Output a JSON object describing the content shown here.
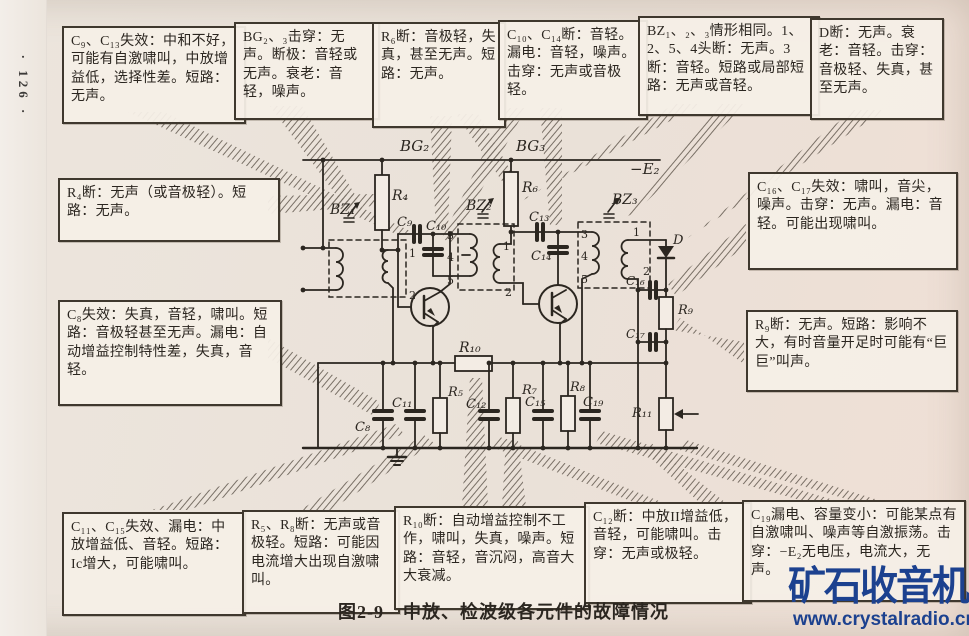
{
  "page_number": "· 126 ·",
  "caption": "图2-9　中放、检波级各元件的故障情况",
  "watermark": {
    "title": "矿石收音机",
    "site": "www.crystalradio.cn",
    "color": "#1c418f"
  },
  "fault_boxes": {
    "c9_c13": {
      "text": "C₉、C₁₃失效：中和不好，可能有自激啸叫，中放增益低，选择性差。短路：无声。"
    },
    "bg2_3": {
      "text": "BG₂、₃击穿：无声。断极：音轻或无声。衰老：音轻，噪声。"
    },
    "r6": {
      "text": "R₆断：音极轻，失真，甚至无声。短路：无声。"
    },
    "c10_c14": {
      "text": "C₁₀、C₁₄断：音轻。漏电：音轻，噪声。击穿：无声或音极轻。"
    },
    "bz1_2_3": {
      "text": "BZ₁、₂、₃情形相同。1、2、5、4头断：无声。3断：音轻。短路或局部短路：无声或音轻。"
    },
    "d": {
      "text": "D断：无声。衰老：音轻。击穿：音极轻、失真，甚至无声。"
    },
    "r4": {
      "text": "R₄断：无声（或音极轻）。短路：无声。"
    },
    "c8": {
      "text": "C₈失效：失真，音轻，啸叫。短路：音极轻甚至无声。漏电：自动增益控制特性差，失真，音轻。"
    },
    "c16_c17": {
      "text": "C₁₆、C₁₇失效：啸叫，音尖，噪声。击穿：无声。漏电：音轻。可能出现啸叫。"
    },
    "r9": {
      "text": "R₉断：无声。短路：影响不大，有时音量开足时可能有“巨巨”叫声。"
    },
    "c11_c15": {
      "text": "C₁₁、C₁₅失效、漏电：中放增益低、音轻。短路：Ic增大，可能啸叫。"
    },
    "r5_r8": {
      "text": "R₅、R₈断：无声或音极轻。短路：可能因电流增大出现自激啸叫。"
    },
    "r10": {
      "text": "R₁₀断：自动增益控制不工作，啸叫，失真，噪声。短路：音轻，音沉闷，高音大大衰减。"
    },
    "c12": {
      "text": "C₁₂断：中放II增益低，音轻，可能啸叫。击穿：无声或极轻。"
    },
    "c19": {
      "text": "C₁₉漏电、容量变小：可能某点有自激啸叫、噪声等自激振荡。击穿：−E₂无电压，电流大，无声。"
    }
  },
  "circuit": {
    "labels": [
      {
        "t": "BG₂",
        "x": 400,
        "y": 151,
        "s": 15,
        "i": 1
      },
      {
        "t": "BG₃",
        "x": 516,
        "y": 151,
        "s": 15,
        "i": 1
      },
      {
        "t": "−E₂",
        "x": 630,
        "y": 174,
        "s": 15,
        "i": 1
      },
      {
        "t": "BZ₁",
        "x": 330,
        "y": 214,
        "s": 14,
        "i": 1
      },
      {
        "t": "BZ₂",
        "x": 466,
        "y": 210,
        "s": 14,
        "i": 1
      },
      {
        "t": "BZ₃",
        "x": 612,
        "y": 204,
        "s": 14,
        "i": 1
      },
      {
        "t": "R₄",
        "x": 392,
        "y": 200,
        "s": 14,
        "i": 1
      },
      {
        "t": "R₆",
        "x": 522,
        "y": 192,
        "s": 14,
        "i": 1
      },
      {
        "t": "C₉",
        "x": 397,
        "y": 226,
        "s": 13,
        "i": 1
      },
      {
        "t": "C₁₀",
        "x": 426,
        "y": 230,
        "s": 13,
        "i": 1
      },
      {
        "t": "C₁₃",
        "x": 529,
        "y": 221,
        "s": 13,
        "i": 1
      },
      {
        "t": "C₁₄",
        "x": 531,
        "y": 260,
        "s": 13,
        "i": 1
      },
      {
        "t": "R₁₀",
        "x": 459,
        "y": 352,
        "s": 14,
        "i": 1
      },
      {
        "t": "C₈",
        "x": 355,
        "y": 431,
        "s": 13,
        "i": 1
      },
      {
        "t": "C₁₁",
        "x": 392,
        "y": 407,
        "s": 13,
        "i": 1
      },
      {
        "t": "R₅",
        "x": 448,
        "y": 396,
        "s": 13,
        "i": 1
      },
      {
        "t": "C₁₂",
        "x": 466,
        "y": 408,
        "s": 13,
        "i": 1
      },
      {
        "t": "R₇",
        "x": 522,
        "y": 394,
        "s": 13,
        "i": 1
      },
      {
        "t": "C₁₅",
        "x": 525,
        "y": 406,
        "s": 13,
        "i": 1
      },
      {
        "t": "R₈",
        "x": 570,
        "y": 391,
        "s": 13,
        "i": 1
      },
      {
        "t": "C₁₉",
        "x": 583,
        "y": 406,
        "s": 13,
        "i": 1
      },
      {
        "t": "R₉",
        "x": 678,
        "y": 314,
        "s": 13,
        "i": 1
      },
      {
        "t": "C₁₆",
        "x": 626,
        "y": 285,
        "s": 12,
        "i": 1
      },
      {
        "t": "C₁₇",
        "x": 626,
        "y": 338,
        "s": 12,
        "i": 1
      },
      {
        "t": "R₁₁",
        "x": 632,
        "y": 417,
        "s": 13,
        "i": 1
      },
      {
        "t": "D",
        "x": 673,
        "y": 244,
        "s": 13,
        "i": 1
      },
      {
        "t": "1",
        "x": 409,
        "y": 257,
        "s": 11
      },
      {
        "t": "2",
        "x": 409,
        "y": 299,
        "s": 11
      },
      {
        "t": "3",
        "x": 447,
        "y": 239,
        "s": 11
      },
      {
        "t": "4",
        "x": 447,
        "y": 261,
        "s": 11
      },
      {
        "t": "5",
        "x": 447,
        "y": 284,
        "s": 11
      },
      {
        "t": "1",
        "x": 503,
        "y": 250,
        "s": 11
      },
      {
        "t": "2",
        "x": 505,
        "y": 296,
        "s": 11
      },
      {
        "t": "3",
        "x": 581,
        "y": 238,
        "s": 11
      },
      {
        "t": "4",
        "x": 581,
        "y": 260,
        "s": 11
      },
      {
        "t": "5",
        "x": 581,
        "y": 283,
        "s": 11
      },
      {
        "t": "1",
        "x": 633,
        "y": 236,
        "s": 11
      },
      {
        "t": "2",
        "x": 643,
        "y": 275,
        "s": 11
      }
    ]
  }
}
